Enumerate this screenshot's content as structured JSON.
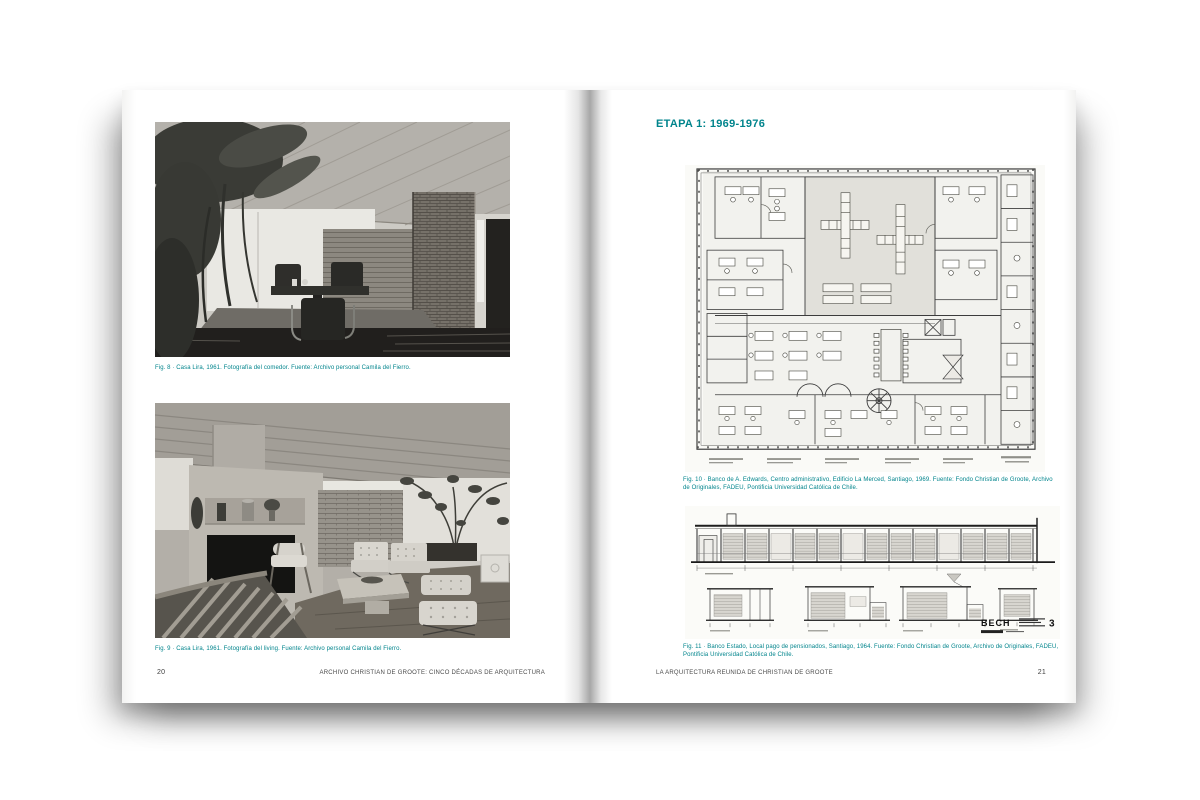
{
  "colors": {
    "accent_teal": "#00848c",
    "footer_text": "#4a4a4a",
    "page_background": "#ffffff"
  },
  "book": {
    "left_page": {
      "figures": [
        {
          "caption": "Fig. 8 · Casa Lira, 1961. Fotografía del comedor. Fuente: Archivo personal Camila del Fierro."
        },
        {
          "caption": "Fig. 9 · Casa Lira, 1961. Fotografía del living. Fuente: Archivo personal Camila del Fierro."
        }
      ],
      "footer_title": "ARCHIVO CHRISTIAN DE GROOTE: CINCO DÉCADAS DE ARQUITECTURA",
      "page_number": "20"
    },
    "right_page": {
      "heading": "ETAPA 1: 1969-1976",
      "figures": [
        {
          "caption": "Fig. 10 · Banco de A. Edwards, Centro administrativo, Edificio La Merced, Santiago, 1969. Fuente: Fondo Christian de Groote, Archivo de Originales, FADEU, Pontificia Universidad Católica de Chile."
        },
        {
          "caption": "Fig. 11 · Banco Estado, Local pago de pensionados, Santiago, 1964. Fuente: Fondo Christian de Groote, Archivo de Originales, FADEU, Pontificia Universidad Católica de Chile."
        }
      ],
      "elevation_stamp": {
        "code": "BECH",
        "number": "3"
      },
      "footer_title": "LA ARQUITECTURA REUNIDA DE CHRISTIAN DE GROOTE",
      "page_number": "21"
    }
  }
}
